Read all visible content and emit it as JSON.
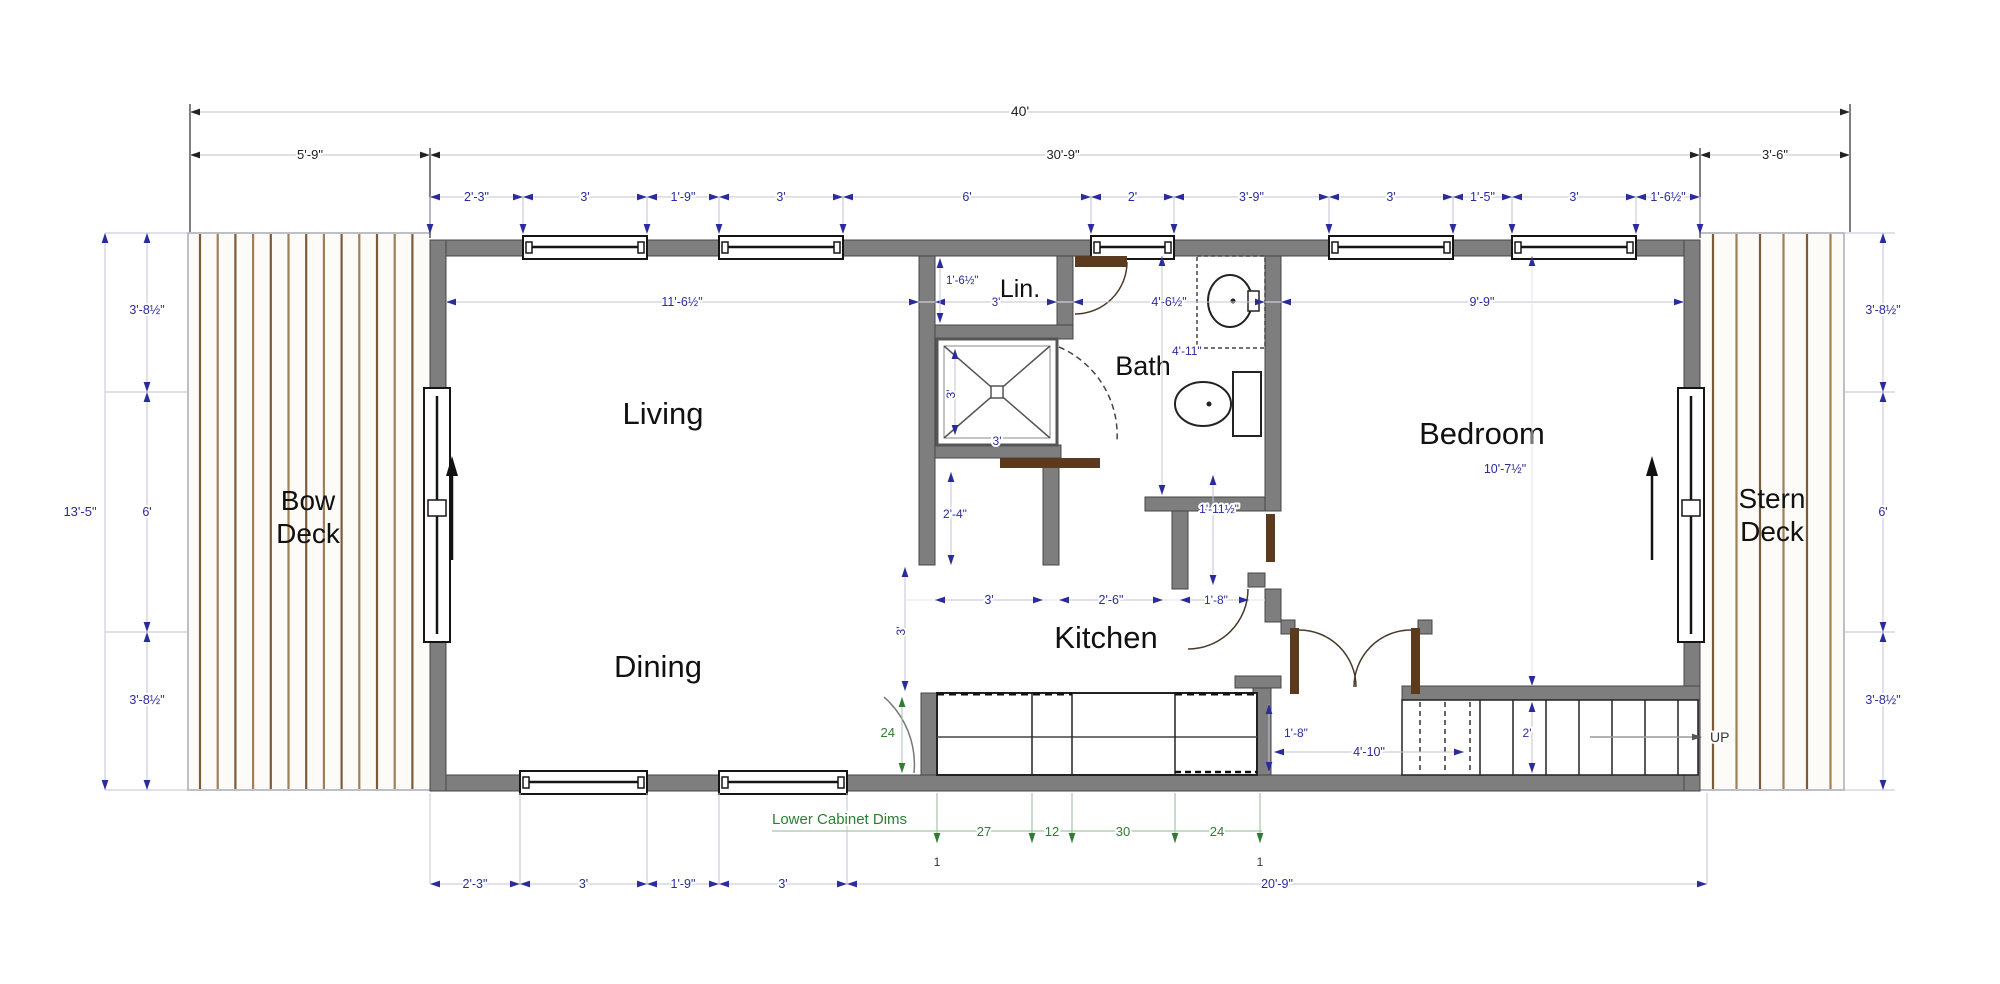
{
  "rooms": {
    "bow_deck": {
      "line1": "Bow",
      "line2": "Deck"
    },
    "stern_deck": {
      "line1": "Stern",
      "line2": "Deck"
    },
    "living": "Living",
    "dining": "Dining",
    "kitchen": "Kitchen",
    "bath": "Bath",
    "linen": "Lin.",
    "bedroom": "Bedroom",
    "up": "UP"
  },
  "overall": {
    "total": "40'",
    "bow": "5'-9\"",
    "cabin": "30'-9\"",
    "stern": "3'-6\"",
    "beam": "13'-5\""
  },
  "left_side": [
    "3'-8½\"",
    "6'",
    "3'-8½\""
  ],
  "right_side": [
    "3'-8½\"",
    "6'",
    "3'-8½\""
  ],
  "top_windows": [
    "2'-3\"",
    "3'",
    "1'-9\"",
    "3'",
    "6'",
    "2'",
    "3'-9\"",
    "3'",
    "1'-5\"",
    "3'",
    "1'-6½\""
  ],
  "bottom_windows": [
    "2'-3\"",
    "3'",
    "1'-9\"",
    "3'"
  ],
  "bottom_overall": "20'-9\"",
  "interior": {
    "living_width": "11'-6½\"",
    "linen_depth": "1'-6½\"",
    "linen_width": "3'",
    "bath_width": "4'-6½\"",
    "bath_length": "4'-11\"",
    "bedroom_width": "9'-9\"",
    "bedroom_length": "10'-7½\"",
    "shower_width": "3'",
    "shower_height": "3'",
    "hall_width": "2'-4\"",
    "dining_pass": "3'",
    "kitchen_pass": "3'",
    "kitchen_opening": "2'-6\"",
    "closet_door": "1'-8\"",
    "closet_width": "1'-11½\"",
    "entry_offset": "1'-8\"",
    "entry_width": "4'-10\"",
    "stair_width": "2'"
  },
  "cabinets": {
    "title": "Lower Cabinet Dims",
    "depth": "24",
    "run": [
      "27",
      "12",
      "30",
      "24"
    ],
    "filler_left": "1",
    "filler_right": "1"
  },
  "colors": {
    "dim_blue": "#2b2b9e",
    "dim_green": "#2e7d32",
    "wall_gray": "#7e7e7e",
    "deck_brown": "#7a5c3a"
  }
}
